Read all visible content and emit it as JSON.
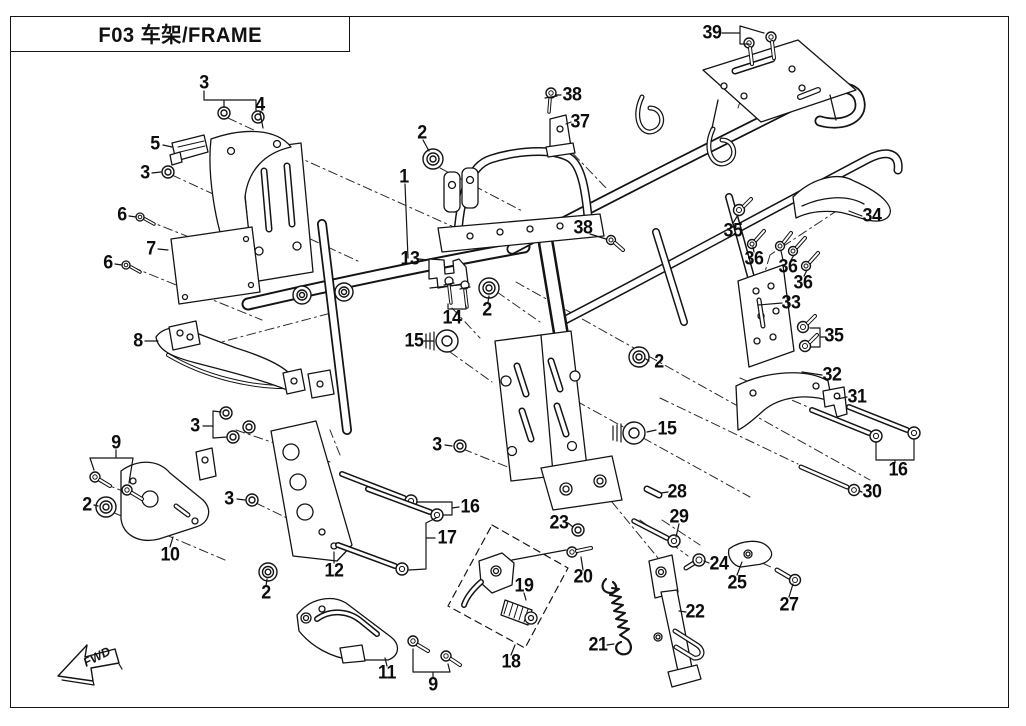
{
  "title": "F03  车架/FRAME",
  "figure": {
    "fwd_label": "FWD",
    "callouts": [
      {
        "label": "39",
        "x": 712,
        "y": 33
      },
      {
        "label": "38",
        "x": 572,
        "y": 95
      },
      {
        "label": "37",
        "x": 580,
        "y": 122
      },
      {
        "label": "3",
        "x": 204,
        "y": 83
      },
      {
        "label": "4",
        "x": 260,
        "y": 105
      },
      {
        "label": "5",
        "x": 155,
        "y": 144
      },
      {
        "label": "3",
        "x": 145,
        "y": 173
      },
      {
        "label": "6",
        "x": 122,
        "y": 215
      },
      {
        "label": "7",
        "x": 151,
        "y": 249
      },
      {
        "label": "6",
        "x": 108,
        "y": 263
      },
      {
        "label": "2",
        "x": 422,
        "y": 133
      },
      {
        "label": "1",
        "x": 404,
        "y": 177
      },
      {
        "label": "13",
        "x": 410,
        "y": 259
      },
      {
        "label": "14",
        "x": 452,
        "y": 318
      },
      {
        "label": "2",
        "x": 487,
        "y": 310
      },
      {
        "label": "15",
        "x": 414,
        "y": 341
      },
      {
        "label": "38",
        "x": 583,
        "y": 228
      },
      {
        "label": "35",
        "x": 733,
        "y": 231
      },
      {
        "label": "34",
        "x": 872,
        "y": 216
      },
      {
        "label": "36",
        "x": 754,
        "y": 259
      },
      {
        "label": "36",
        "x": 788,
        "y": 267
      },
      {
        "label": "36",
        "x": 803,
        "y": 283
      },
      {
        "label": "33",
        "x": 791,
        "y": 303
      },
      {
        "label": "35",
        "x": 834,
        "y": 336
      },
      {
        "label": "32",
        "x": 832,
        "y": 375
      },
      {
        "label": "31",
        "x": 857,
        "y": 397
      },
      {
        "label": "16",
        "x": 898,
        "y": 470
      },
      {
        "label": "30",
        "x": 872,
        "y": 492
      },
      {
        "label": "2",
        "x": 659,
        "y": 362
      },
      {
        "label": "15",
        "x": 667,
        "y": 429
      },
      {
        "label": "3",
        "x": 437,
        "y": 445
      },
      {
        "label": "8",
        "x": 138,
        "y": 341
      },
      {
        "label": "3",
        "x": 195,
        "y": 426
      },
      {
        "label": "9",
        "x": 116,
        "y": 443
      },
      {
        "label": "2",
        "x": 87,
        "y": 505
      },
      {
        "label": "3",
        "x": 229,
        "y": 499
      },
      {
        "label": "10",
        "x": 170,
        "y": 555
      },
      {
        "label": "2",
        "x": 266,
        "y": 593
      },
      {
        "label": "16",
        "x": 470,
        "y": 507
      },
      {
        "label": "17",
        "x": 447,
        "y": 538
      },
      {
        "label": "12",
        "x": 334,
        "y": 571
      },
      {
        "label": "28",
        "x": 677,
        "y": 492
      },
      {
        "label": "23",
        "x": 559,
        "y": 523
      },
      {
        "label": "29",
        "x": 679,
        "y": 517
      },
      {
        "label": "20",
        "x": 583,
        "y": 577
      },
      {
        "label": "24",
        "x": 719,
        "y": 564
      },
      {
        "label": "25",
        "x": 737,
        "y": 583
      },
      {
        "label": "27",
        "x": 789,
        "y": 605
      },
      {
        "label": "22",
        "x": 695,
        "y": 612
      },
      {
        "label": "21",
        "x": 598,
        "y": 645
      },
      {
        "label": "19",
        "x": 524,
        "y": 586
      },
      {
        "label": "18",
        "x": 511,
        "y": 662
      },
      {
        "label": "11",
        "x": 387,
        "y": 673
      },
      {
        "label": "9",
        "x": 433,
        "y": 685
      }
    ]
  }
}
